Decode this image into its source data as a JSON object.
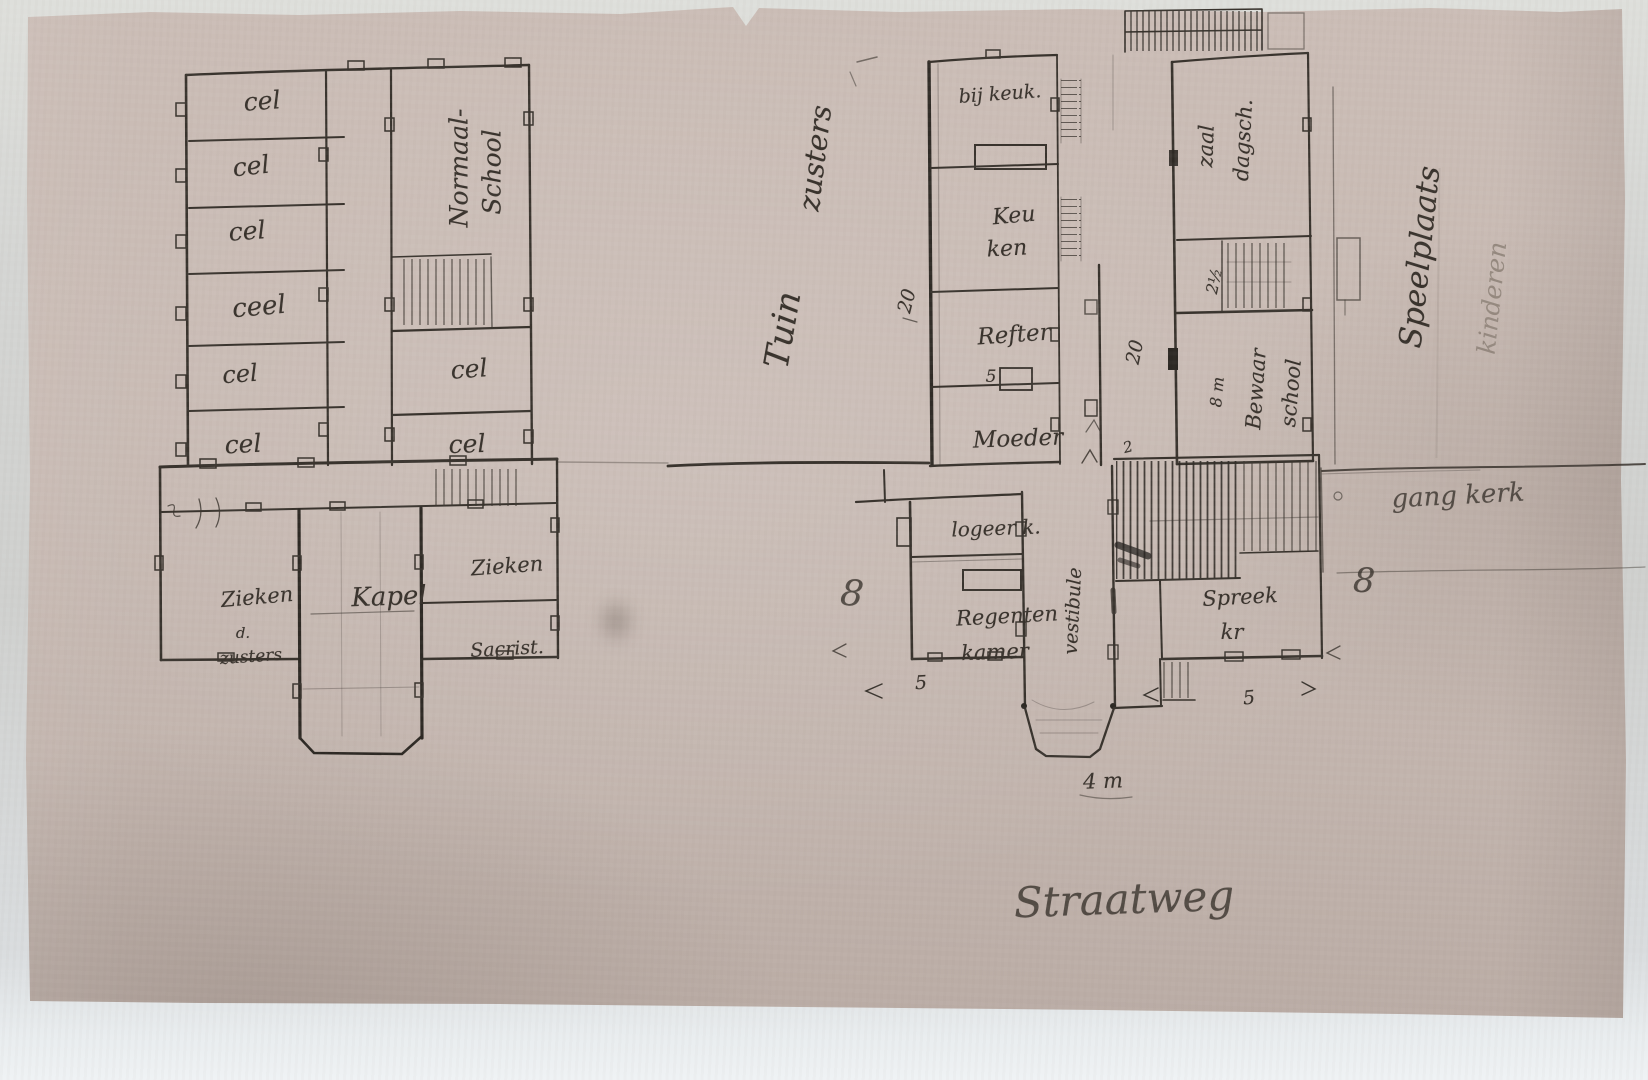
{
  "left_plan": {
    "cells_left": [
      "cel",
      "cel",
      "cel",
      "ceel",
      "cel",
      "cel"
    ],
    "cells_right": [
      "cel",
      "cel"
    ],
    "normal_school": [
      "Normaal-",
      "School"
    ],
    "infirmary_sisters": [
      "Zieken",
      "d.",
      "zusters"
    ],
    "chapel": "Kapel",
    "infirmary": "Zieken",
    "sacristy": "Sacrist."
  },
  "right_plan": {
    "garden": [
      "Tuin",
      "zusters"
    ],
    "scullery": "bij keuk.",
    "kitchen": [
      "Keu",
      "ken"
    ],
    "refectory": "Refter",
    "mother_superior": "Moeder",
    "day_school_room": [
      "zaal",
      "dagsch."
    ],
    "nursery_school": [
      "8 m",
      "Bewaar",
      "school"
    ],
    "playground": [
      "Speelplaats",
      "kinderen"
    ],
    "guest_room": "logeer k.",
    "regents_room": [
      "Regenten",
      "kamer"
    ],
    "vestibule": "vestibule",
    "parlor": [
      "Spreek",
      "kr"
    ],
    "church_passage": "gang kerk"
  },
  "street": "Straatweg",
  "dimensions": {
    "left_wing_depth": "20",
    "corridor_depth": "20",
    "corridor_width": "2",
    "stair_width": "2½",
    "refectory_width": "5",
    "guest_block_width": "5",
    "parlor_width": "5",
    "porch_width": "4 m",
    "mark_left": "8",
    "mark_right": "8"
  },
  "colors": {
    "paper": "#c6b8b1",
    "ink": "#38322c",
    "pencil": "#8d8177",
    "margin": "#d6d8d6"
  }
}
